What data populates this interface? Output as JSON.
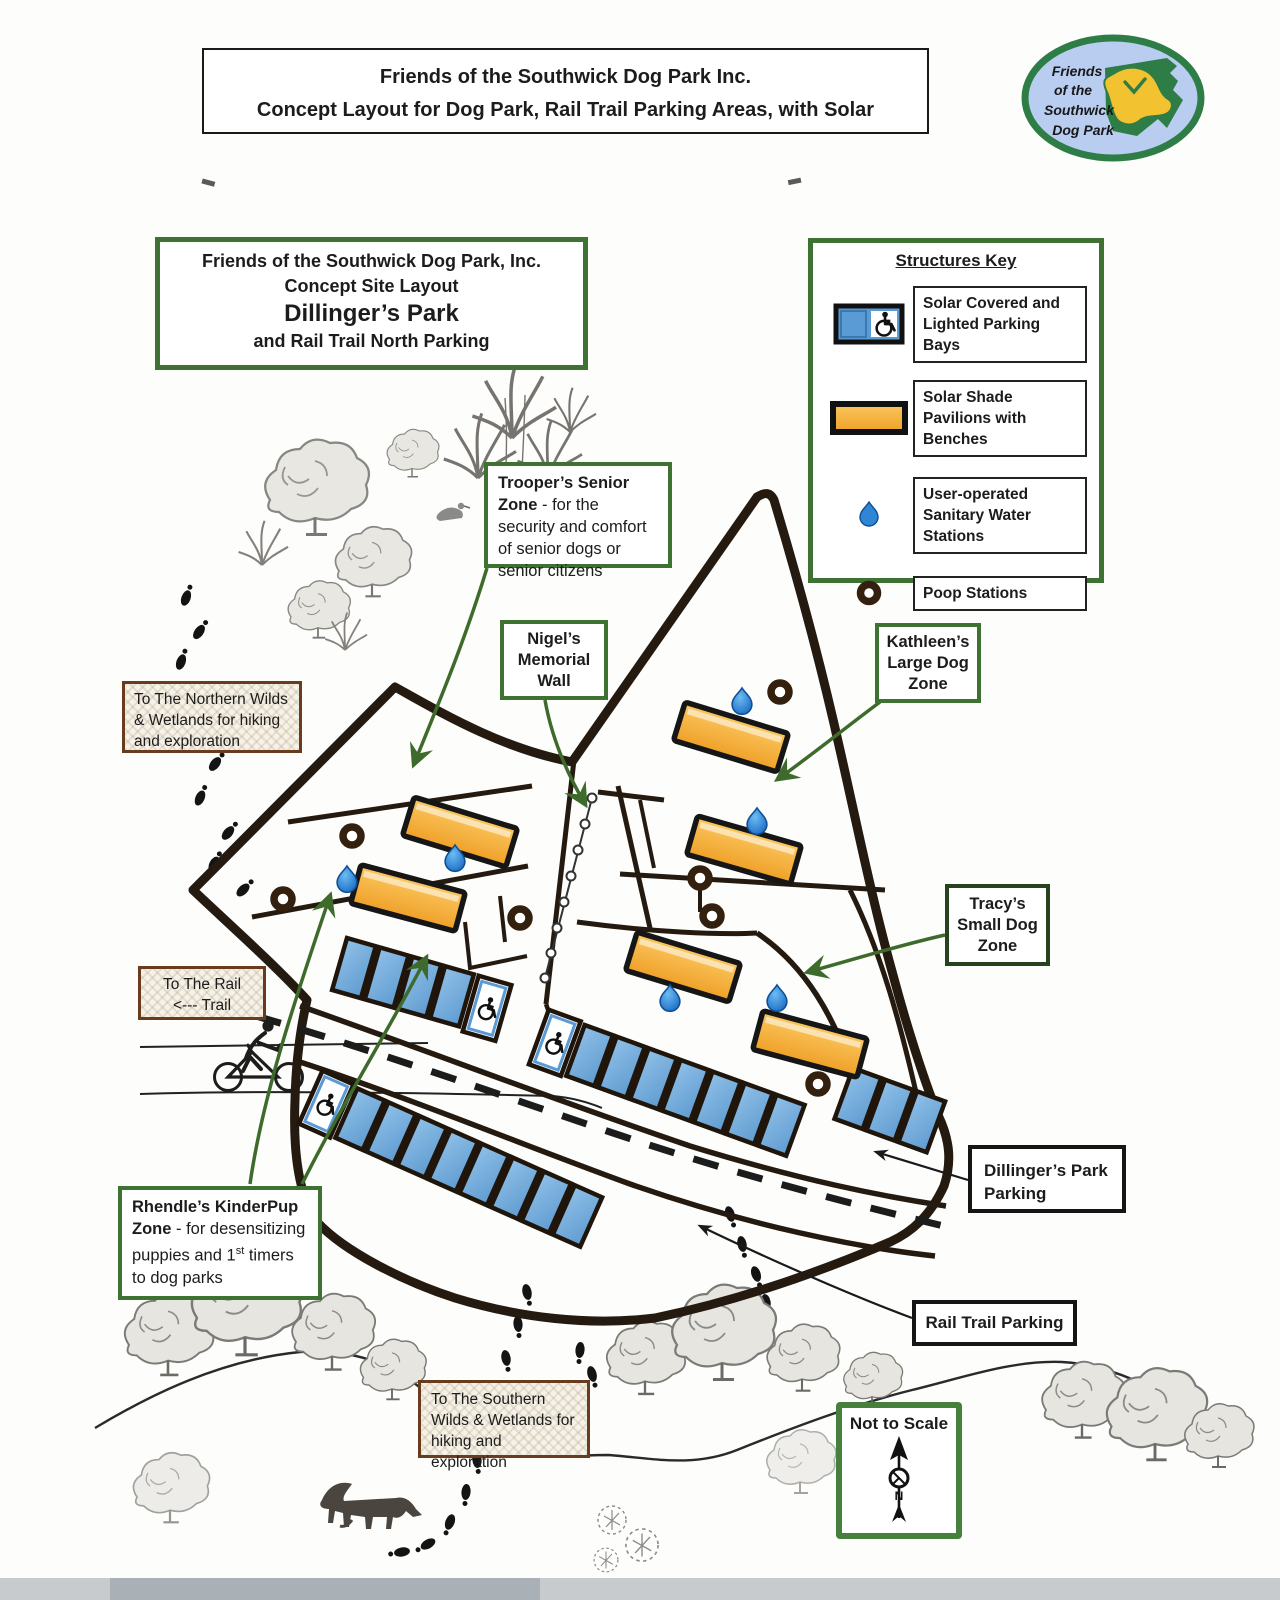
{
  "header": {
    "line1": "Friends of the Southwick Dog Park Inc.",
    "line2": "Concept Layout for Dog Park, Rail Trail Parking Areas, with Solar"
  },
  "logo": {
    "line1": "Friends",
    "line2": "of the",
    "line3": "Southwick",
    "line4": "Dog Park"
  },
  "site_box": {
    "line1": "Friends of the Southwick Dog Park, Inc.",
    "line2": "Concept Site Layout",
    "line3": "Dillinger’s Park",
    "line4": "and Rail Trail North Parking"
  },
  "key": {
    "title": "Structures Key",
    "items": [
      {
        "icon": "parking-bay-icon",
        "label": "Solar Covered and Lighted Parking Bays"
      },
      {
        "icon": "pavilion-icon",
        "label": "Solar Shade Pavilions with Benches"
      },
      {
        "icon": "water-drop-icon",
        "label": "User-operated Sanitary Water Stations"
      },
      {
        "icon": "poop-station-icon",
        "label": "Poop Stations"
      }
    ]
  },
  "labels": {
    "troopers_title": "Trooper’s Senior Zone",
    "troopers_desc": " - for the security and comfort of senior dogs or senior citizens",
    "nigels": "Nigel’s Memorial Wall",
    "kathleens": "Kathleen’s Large Dog Zone",
    "tracys": "Tracy’s Small Dog Zone",
    "northern": "To The Northern Wilds & Wetlands for hiking and exploration",
    "rail_line1": "To The Rail",
    "rail_line2": "<--- Trail",
    "rhendles_title": "Rhendle’s KinderPup Zone",
    "rhendles_desc_pre": " - for desensitizing puppies and 1",
    "rhendles_sup": "st",
    "rhendles_desc_post": " timers to dog parks",
    "dillingers_parking": "Dillinger’s Park Parking",
    "rail_trail_parking": "Rail Trail Parking",
    "southern": "To The Southern Wilds & Wetlands for hiking and exploration",
    "not_to_scale": "Not to Scale",
    "compass_n": "N"
  },
  "colors": {
    "ink": "#241a10",
    "box_green": "#3e7233",
    "arrow_green": "#3e6b2c",
    "box_brown": "#693c1d",
    "bay_blue": "#6fa8d8",
    "pavilion_orange": "#f5b03c",
    "water_blue": "#2e86d4",
    "logo_green": "#2e7d46",
    "logo_blue": "#b8cdf0",
    "logo_yellow": "#f2c230"
  }
}
